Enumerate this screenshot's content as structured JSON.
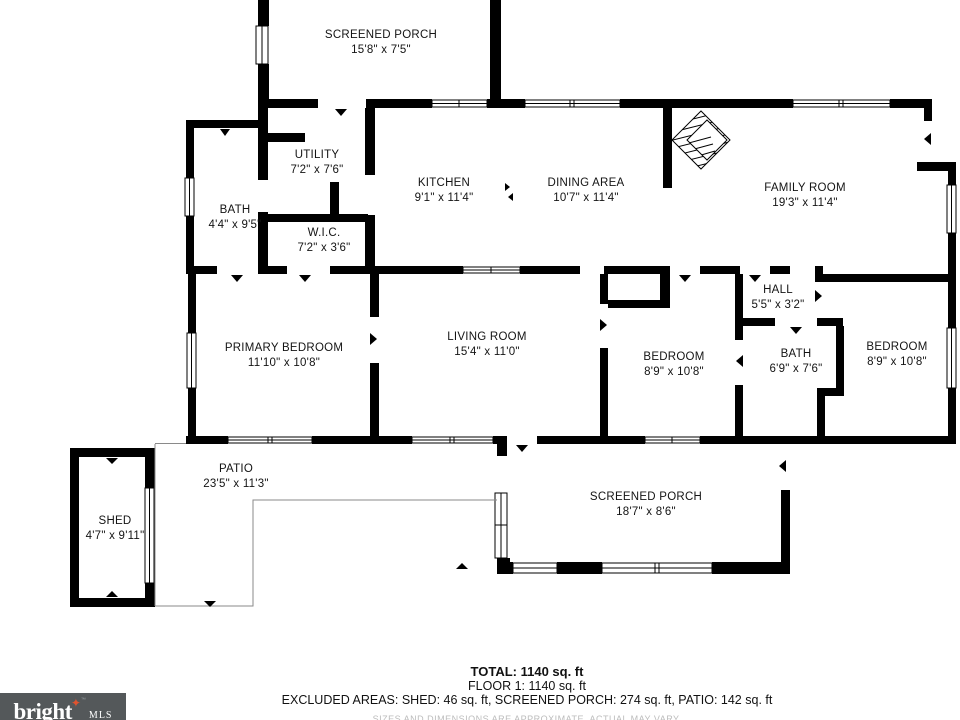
{
  "plan": {
    "rooms": [
      {
        "name": "SCREENED PORCH",
        "dims": "15'8\" x 7'5\"",
        "cx": 381,
        "top": 28
      },
      {
        "name": "UTILITY",
        "dims": "7'2\" x 7'6\"",
        "cx": 317,
        "top": 148
      },
      {
        "name": "BATH",
        "dims": "4'4\" x 9'5\"",
        "cx": 235,
        "top": 203
      },
      {
        "name": "W.I.C.",
        "dims": "7'2\" x 3'6\"",
        "cx": 324,
        "top": 226
      },
      {
        "name": "KITCHEN",
        "dims": "9'1\" x 11'4\"",
        "cx": 444,
        "top": 176
      },
      {
        "name": "DINING AREA",
        "dims": "10'7\" x 11'4\"",
        "cx": 586,
        "top": 176
      },
      {
        "name": "FAMILY ROOM",
        "dims": "19'3\" x 11'4\"",
        "cx": 805,
        "top": 181
      },
      {
        "name": "HALL",
        "dims": "5'5\" x 3'2\"",
        "cx": 778,
        "top": 283
      },
      {
        "name": "PRIMARY BEDROOM",
        "dims": "11'10\" x 10'8\"",
        "cx": 284,
        "top": 341
      },
      {
        "name": "LIVING ROOM",
        "dims": "15'4\" x 11'0\"",
        "cx": 487,
        "top": 330
      },
      {
        "name": "BEDROOM",
        "dims": "8'9\" x 10'8\"",
        "cx": 674,
        "top": 350
      },
      {
        "name": "BATH",
        "dims": "6'9\" x 7'6\"",
        "cx": 796,
        "top": 347
      },
      {
        "name": "BEDROOM",
        "dims": "8'9\" x 10'8\"",
        "cx": 897,
        "top": 340
      },
      {
        "name": "PATIO",
        "dims": "23'5\" x 11'3\"",
        "cx": 236,
        "top": 462
      },
      {
        "name": "SHED",
        "dims": "4'7\" x 9'11\"",
        "cx": 115,
        "top": 514
      },
      {
        "name": "SCREENED PORCH",
        "dims": "18'7\" x 8'6\"",
        "cx": 646,
        "top": 490
      }
    ]
  },
  "summary": {
    "total": "TOTAL: 1140 sq. ft",
    "floor": "FLOOR 1: 1140 sq. ft",
    "excluded": "EXCLUDED AREAS: SHED: 46 sq. ft, SCREENED PORCH: 274 sq. ft, PATIO: 142 sq. ft",
    "disclaimer": "SIZES AND DIMENSIONS ARE APPROXIMATE, ACTUAL MAY VARY."
  },
  "logo": {
    "brand": "bright",
    "suffix": "MLS",
    "tm": "TM"
  },
  "colors": {
    "wall": "#000000",
    "accent": "#e0532f",
    "logo_bg": "#54585a",
    "disclaimer": "#bcbcbc",
    "patio_line": "#8a8a8a"
  }
}
